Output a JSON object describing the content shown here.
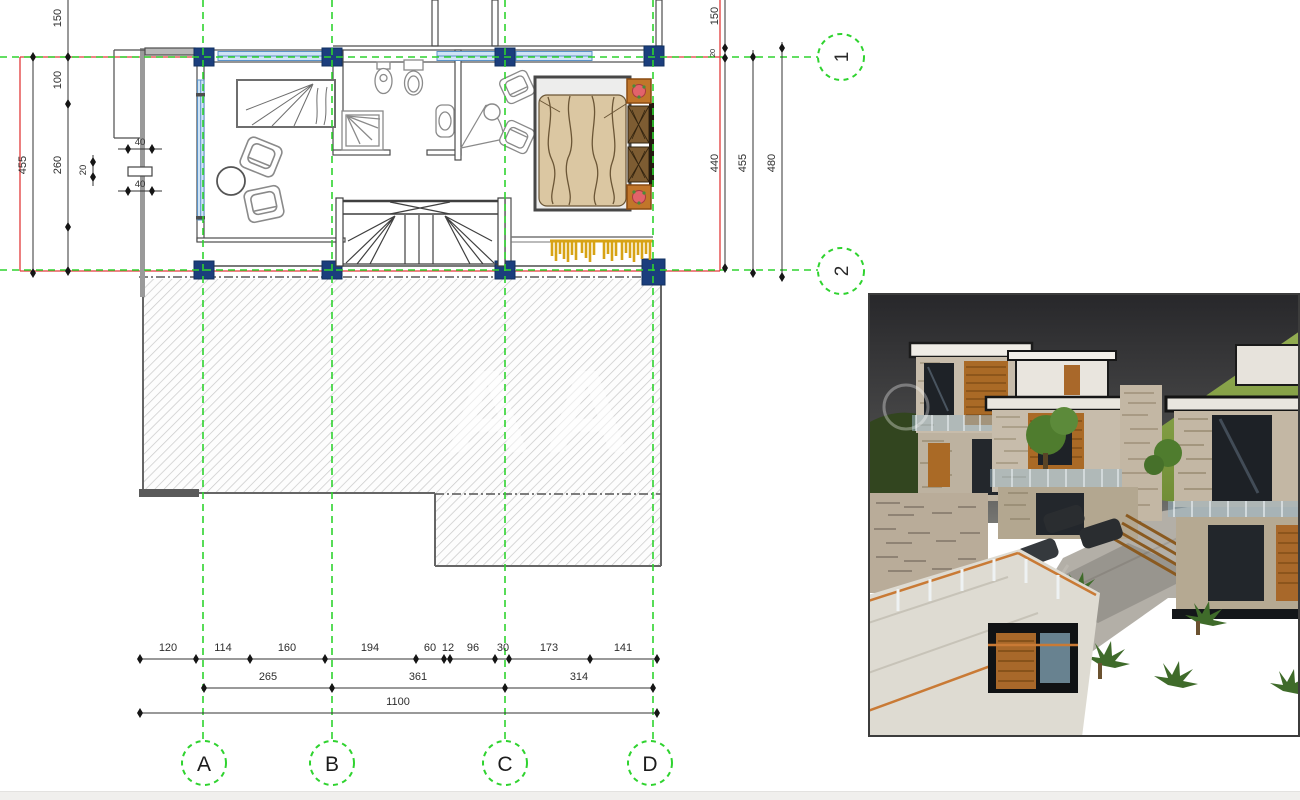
{
  "plan": {
    "grid": {
      "columns": [
        {
          "label": "A"
        },
        {
          "label": "B"
        },
        {
          "label": "C"
        },
        {
          "label": "D"
        }
      ],
      "rows": [
        {
          "label": "1"
        },
        {
          "label": "2"
        }
      ]
    },
    "dims": {
      "h_segments": [
        "120",
        "114",
        "160",
        "194",
        "60",
        "12",
        "96",
        "30",
        "173",
        "141"
      ],
      "h_axes": [
        "265",
        "361",
        "314"
      ],
      "h_total": "1100",
      "left": {
        "top": "150",
        "upper": "100",
        "mid": "260",
        "overall": "455"
      },
      "right": {
        "top": "150",
        "offset": "20",
        "inner": "440",
        "mid": "455",
        "outer": "480"
      },
      "detail": {
        "top": "40",
        "side": "20",
        "bottom": "40"
      }
    }
  },
  "watermark": {
    "text": "AA"
  },
  "colors": {
    "grid_green": "#2fd32f",
    "slab_red": "#e13a3a",
    "column_blue": "#1b3e7d",
    "window_blue_fill": "#cfe4f5",
    "window_blue_stroke": "#5b93c8",
    "wall_gray": "#4d4d4d",
    "hatch_line_gray": "#c8c8c8",
    "fringe_gold": "#d7a315",
    "bed_blanket_tan": "#dbc7a2",
    "wardrobe_brown": "#7d5c32",
    "nightstand_orange": "#c1762a",
    "flower_red": "#e2636b"
  }
}
